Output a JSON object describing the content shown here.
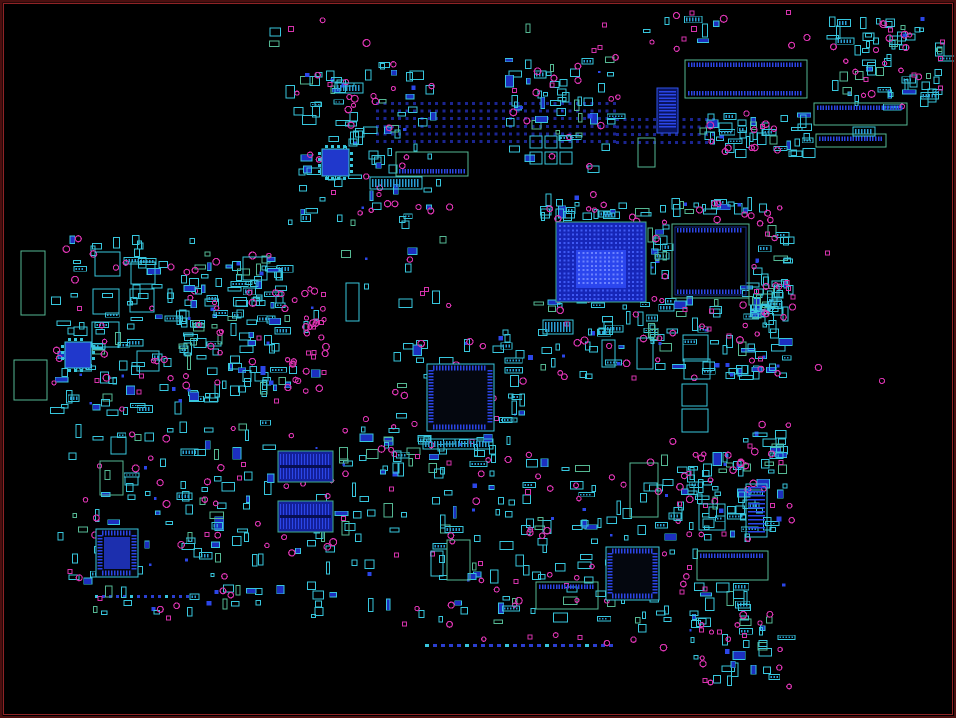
{
  "app": {
    "view_title": "pcb-boardview"
  },
  "board": {
    "width": 956,
    "height": 718,
    "bg": "#000000",
    "frame": {
      "dark": "#4a0f0f",
      "bright": "#8f2326"
    },
    "colors": {
      "cyan": "#38c6dd",
      "pale": "#55b893",
      "teal": "#3fae8c",
      "blue_fill": "#1c2fc0",
      "blue_bright": "#2b46e8",
      "blue_dark": "#0c17a0",
      "via": "#1b2590",
      "magenta": "#d633ad",
      "mem_fill": "#13209a",
      "core_dark": "#04070f",
      "bga_fill": "#1626b8",
      "bga_dot": "#3f5af5",
      "bga_center": "#2b46ee",
      "hatch": "#2b9fd6"
    },
    "via_grids": [
      {
        "x": 376,
        "y": 102,
        "cols": 33,
        "rows": 6,
        "dx": 7.4,
        "dy": 7.6,
        "w": 3,
        "h": 3
      },
      {
        "x": 616,
        "y": 118,
        "cols": 14,
        "rows": 4,
        "dx": 7.4,
        "dy": 7.6,
        "w": 3,
        "h": 3
      }
    ],
    "dash_rows": [
      {
        "x": 425,
        "y": 644,
        "count": 24,
        "dx": 8,
        "w": 4,
        "h": 3
      },
      {
        "x": 95,
        "y": 595,
        "count": 14,
        "dx": 7,
        "w": 3,
        "h": 3
      }
    ],
    "major_components": [
      {
        "name": "bga-chip",
        "style": "bga",
        "x": 556,
        "y": 222,
        "w": 90,
        "h": 80
      },
      {
        "name": "cpu-socket",
        "style": "socket",
        "x": 672,
        "y": 224,
        "w": 77,
        "h": 74
      },
      {
        "name": "qfp-center",
        "style": "qfp",
        "x": 427,
        "y": 364,
        "w": 67,
        "h": 67
      },
      {
        "name": "qfp-bottom-right",
        "style": "qfp",
        "x": 606,
        "y": 547,
        "w": 53,
        "h": 53
      },
      {
        "name": "qfp-bottom-left",
        "style": "qfp_filled",
        "x": 96,
        "y": 529,
        "w": 42,
        "h": 48
      },
      {
        "name": "qfn-left",
        "style": "qfn",
        "x": 65,
        "y": 342,
        "w": 26,
        "h": 26
      },
      {
        "name": "qfn-top",
        "style": "qfn",
        "x": 322,
        "y": 149,
        "w": 27,
        "h": 27
      },
      {
        "name": "connector-top-center",
        "style": "connector",
        "pins": [
          "bottom"
        ],
        "x": 396,
        "y": 152,
        "w": 72,
        "h": 24
      },
      {
        "name": "connector-top-right",
        "style": "connector",
        "pins": [
          "top",
          "bottom"
        ],
        "x": 685,
        "y": 60,
        "w": 122,
        "h": 38
      },
      {
        "name": "connector-right-2",
        "style": "connector",
        "pins": [
          "top"
        ],
        "x": 814,
        "y": 103,
        "w": 93,
        "h": 22
      },
      {
        "name": "connector-right-3",
        "style": "connector",
        "pins": [
          "top"
        ],
        "x": 816,
        "y": 134,
        "w": 70,
        "h": 13
      },
      {
        "name": "connector-bottom-1",
        "style": "connector",
        "pins": [
          "top"
        ],
        "x": 536,
        "y": 582,
        "w": 62,
        "h": 27
      },
      {
        "name": "connector-bottom-2",
        "style": "connector",
        "pins": [
          "top"
        ],
        "x": 697,
        "y": 551,
        "w": 71,
        "h": 29
      },
      {
        "name": "vertical-connector",
        "style": "vconn",
        "x": 657,
        "y": 88,
        "w": 21,
        "h": 45
      },
      {
        "name": "vpins-right",
        "style": "vpins",
        "x": 746,
        "y": 484,
        "w": 21,
        "h": 53
      },
      {
        "name": "memory-chip-1",
        "style": "mem",
        "x": 278,
        "y": 451,
        "w": 55,
        "h": 31
      },
      {
        "name": "memory-chip-2",
        "style": "mem",
        "x": 278,
        "y": 501,
        "w": 55,
        "h": 31
      },
      {
        "name": "tall-rect-left",
        "style": "outline_pale",
        "x": 21,
        "y": 251,
        "w": 24,
        "h": 64
      },
      {
        "name": "rect-left-2",
        "style": "outline_pale",
        "x": 14,
        "y": 360,
        "w": 33,
        "h": 40
      },
      {
        "name": "rect-100",
        "style": "outline_pale",
        "x": 100,
        "y": 461,
        "w": 23,
        "h": 34
      },
      {
        "name": "vrect-638",
        "style": "outline_pale",
        "x": 638,
        "y": 138,
        "w": 17,
        "h": 29
      },
      {
        "name": "vrect-bottom-center",
        "style": "outline_pale",
        "x": 630,
        "y": 463,
        "w": 28,
        "h": 54
      },
      {
        "name": "vrect-447",
        "style": "outline_pale",
        "x": 447,
        "y": 540,
        "w": 23,
        "h": 40
      },
      {
        "name": "sq-chain-1",
        "style": "outline",
        "x": 683,
        "y": 335,
        "w": 25,
        "h": 26
      },
      {
        "name": "sq-chain-2",
        "style": "outline",
        "x": 684,
        "y": 359,
        "w": 26,
        "h": 20
      },
      {
        "name": "sq-chain-3",
        "style": "outline",
        "x": 682,
        "y": 384,
        "w": 25,
        "h": 22
      },
      {
        "name": "sq-chain-4",
        "style": "outline",
        "x": 682,
        "y": 409,
        "w": 26,
        "h": 23
      },
      {
        "name": "rect-637",
        "style": "outline",
        "x": 637,
        "y": 338,
        "w": 16,
        "h": 31
      },
      {
        "name": "rect-602",
        "style": "outline",
        "x": 602,
        "y": 340,
        "w": 13,
        "h": 27
      },
      {
        "name": "chip-700",
        "style": "outline",
        "x": 699,
        "y": 504,
        "w": 26,
        "h": 26
      },
      {
        "name": "sq-111",
        "style": "outline",
        "x": 111,
        "y": 437,
        "w": 15,
        "h": 17
      },
      {
        "name": "vrect-346",
        "style": "outline",
        "x": 346,
        "y": 283,
        "w": 13,
        "h": 38
      },
      {
        "name": "vrect-431",
        "style": "outline",
        "x": 431,
        "y": 551,
        "w": 12,
        "h": 25
      },
      {
        "name": "sq-left-1",
        "style": "outline",
        "x": 95,
        "y": 252,
        "w": 25,
        "h": 24
      },
      {
        "name": "sq-left-2",
        "style": "outline",
        "x": 131,
        "y": 262,
        "w": 24,
        "h": 22
      },
      {
        "name": "sq-left-3",
        "style": "outline",
        "x": 93,
        "y": 289,
        "w": 26,
        "h": 25
      },
      {
        "name": "sq-left-4",
        "style": "outline",
        "x": 130,
        "y": 289,
        "w": 24,
        "h": 23
      },
      {
        "name": "sq-left-5",
        "style": "outline",
        "x": 92,
        "y": 322,
        "w": 27,
        "h": 25
      },
      {
        "name": "sq-left-6",
        "style": "outline",
        "x": 137,
        "y": 351,
        "w": 22,
        "h": 20
      },
      {
        "name": "sq-246",
        "style": "outline",
        "x": 243,
        "y": 257,
        "w": 24,
        "h": 23
      },
      {
        "name": "sq-row-1",
        "style": "outline",
        "x": 530,
        "y": 136,
        "w": 12,
        "h": 12
      },
      {
        "name": "sq-row-2",
        "style": "outline",
        "x": 545,
        "y": 136,
        "w": 12,
        "h": 12
      },
      {
        "name": "sq-row-3",
        "style": "outline",
        "x": 560,
        "y": 136,
        "w": 12,
        "h": 12
      },
      {
        "name": "sq-row-4",
        "style": "outline",
        "x": 530,
        "y": 152,
        "w": 12,
        "h": 12
      },
      {
        "name": "sq-row-5",
        "style": "outline",
        "x": 545,
        "y": 152,
        "w": 12,
        "h": 12
      },
      {
        "name": "sq-row-6",
        "style": "outline",
        "x": 560,
        "y": 152,
        "w": 12,
        "h": 12
      },
      {
        "name": "hconn-335",
        "style": "hrow",
        "x": 335,
        "y": 83,
        "w": 28,
        "h": 10
      },
      {
        "name": "hrow-370",
        "style": "hrow",
        "x": 370,
        "y": 177,
        "w": 52,
        "h": 12
      },
      {
        "name": "hrow-423",
        "style": "hrow",
        "x": 423,
        "y": 439,
        "w": 70,
        "h": 10
      },
      {
        "name": "hrow-543",
        "style": "hrow",
        "x": 543,
        "y": 320,
        "w": 30,
        "h": 14
      },
      {
        "name": "hrow-853",
        "style": "hrow",
        "x": 853,
        "y": 127,
        "w": 22,
        "h": 9
      }
    ],
    "clusters": [
      {
        "name": "top-center",
        "x": 286,
        "y": 62,
        "w": 155,
        "h": 172,
        "parts": 85,
        "testpoints": 28,
        "seed": 11
      },
      {
        "name": "bga-left",
        "x": 505,
        "y": 55,
        "w": 115,
        "h": 118,
        "parts": 48,
        "testpoints": 16,
        "seed": 12
      },
      {
        "name": "top-right",
        "x": 824,
        "y": 14,
        "w": 122,
        "h": 96,
        "parts": 60,
        "testpoints": 22,
        "seed": 13
      },
      {
        "name": "tr-mid",
        "x": 700,
        "y": 112,
        "w": 115,
        "h": 46,
        "parts": 38,
        "testpoints": 12,
        "seed": 14
      },
      {
        "name": "top-sparse",
        "x": 640,
        "y": 12,
        "w": 170,
        "h": 46,
        "parts": 6,
        "testpoints": 8,
        "seed": 15
      },
      {
        "name": "left-mid",
        "x": 50,
        "y": 232,
        "w": 145,
        "h": 185,
        "parts": 80,
        "testpoints": 26,
        "seed": 16
      },
      {
        "name": "res-grid",
        "x": 178,
        "y": 252,
        "w": 112,
        "h": 150,
        "parts": 120,
        "testpoints": 22,
        "seed": 17
      },
      {
        "name": "tp-cloud",
        "x": 282,
        "y": 282,
        "w": 44,
        "h": 112,
        "parts": 6,
        "testpoints": 34,
        "seed": 18
      },
      {
        "name": "center",
        "x": 393,
        "y": 330,
        "w": 132,
        "h": 148,
        "parts": 60,
        "testpoints": 24,
        "seed": 19
      },
      {
        "name": "mid-right",
        "x": 528,
        "y": 295,
        "w": 255,
        "h": 85,
        "parts": 78,
        "testpoints": 26,
        "seed": 20
      },
      {
        "name": "bga-right-gap",
        "x": 648,
        "y": 222,
        "w": 24,
        "h": 84,
        "parts": 14,
        "testpoints": 4,
        "seed": 21
      },
      {
        "name": "socket-top",
        "x": 660,
        "y": 196,
        "w": 120,
        "h": 28,
        "parts": 18,
        "testpoints": 8,
        "seed": 22
      },
      {
        "name": "bga-top",
        "x": 540,
        "y": 194,
        "w": 118,
        "h": 30,
        "parts": 20,
        "testpoints": 8,
        "seed": 23
      },
      {
        "name": "socket-right",
        "x": 750,
        "y": 220,
        "w": 46,
        "h": 98,
        "parts": 26,
        "testpoints": 10,
        "seed": 24
      },
      {
        "name": "right-strip-1",
        "x": 738,
        "y": 282,
        "w": 56,
        "h": 100,
        "parts": 30,
        "testpoints": 12,
        "seed": 25
      },
      {
        "name": "right-strip-2",
        "x": 736,
        "y": 420,
        "w": 58,
        "h": 112,
        "parts": 34,
        "testpoints": 14,
        "seed": 26
      },
      {
        "name": "right-mid-low",
        "x": 678,
        "y": 452,
        "w": 72,
        "h": 92,
        "parts": 40,
        "testpoints": 16,
        "seed": 27
      },
      {
        "name": "bottom-left",
        "x": 58,
        "y": 418,
        "w": 350,
        "h": 202,
        "parts": 150,
        "testpoints": 52,
        "seed": 28
      },
      {
        "name": "bottom-center",
        "x": 430,
        "y": 440,
        "w": 268,
        "h": 185,
        "parts": 105,
        "testpoints": 42,
        "seed": 29
      },
      {
        "name": "bottom-right",
        "x": 688,
        "y": 583,
        "w": 105,
        "h": 106,
        "parts": 40,
        "testpoints": 18,
        "seed": 30
      },
      {
        "name": "sparse-band-top",
        "x": 250,
        "y": 12,
        "w": 420,
        "h": 46,
        "parts": 3,
        "testpoints": 6,
        "seed": 31
      },
      {
        "name": "sparse-bottom",
        "x": 300,
        "y": 598,
        "w": 400,
        "h": 55,
        "parts": 4,
        "testpoints": 10,
        "seed": 32
      },
      {
        "name": "sparse-mid",
        "x": 340,
        "y": 200,
        "w": 110,
        "h": 120,
        "parts": 8,
        "testpoints": 6,
        "seed": 33
      },
      {
        "name": "sparse-right",
        "x": 800,
        "y": 175,
        "w": 135,
        "h": 250,
        "parts": 0,
        "testpoints": 3,
        "seed": 34
      }
    ],
    "explicit_testpoints": [
      {
        "x": 291,
        "y": 29,
        "shape": "square"
      },
      {
        "x": 694,
        "y": 29,
        "shape": "square"
      },
      {
        "x": 528,
        "y": 492,
        "shape": "square"
      }
    ]
  }
}
